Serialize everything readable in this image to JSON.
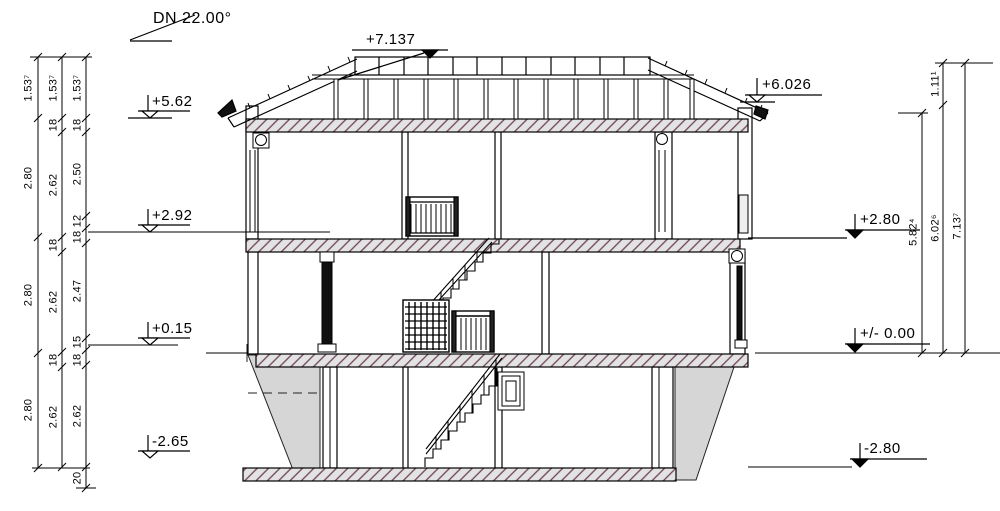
{
  "annotations": {
    "roof_pitch": "DN 22.00°",
    "ridge": "+7.137",
    "eave_left": "+5.62",
    "upper_floor": "+2.92",
    "ground_floor": "+0.15",
    "basement_left": "-2.65",
    "eave_right": "+6.026",
    "upper_slab_right": "+2.80",
    "ground_zero": "+/- 0.00",
    "basement_right": "-2.80"
  },
  "dimensions": {
    "left_outer": [
      "1.53⁷",
      "2.80",
      "2.80",
      "2.80"
    ],
    "left_middle": [
      "1.53⁷",
      "18",
      "2.62",
      "18",
      "2.62",
      "18",
      "2.62"
    ],
    "left_inner": [
      "1.53⁷",
      "18",
      "2.50",
      "12",
      "18",
      "2.47",
      "15",
      "18",
      "2.62",
      "20"
    ],
    "right_ridge_to_eave": "1.11¹",
    "right_eave_height": "5.82⁴",
    "right_mid_height": "6.02⁶",
    "right_total_height": "7.13⁷"
  },
  "colors": {
    "line": "#000000",
    "slab_fill": "#e3e3e3",
    "slab_hatch": "#6d4258",
    "earth_fill": "#d6d6d6"
  }
}
